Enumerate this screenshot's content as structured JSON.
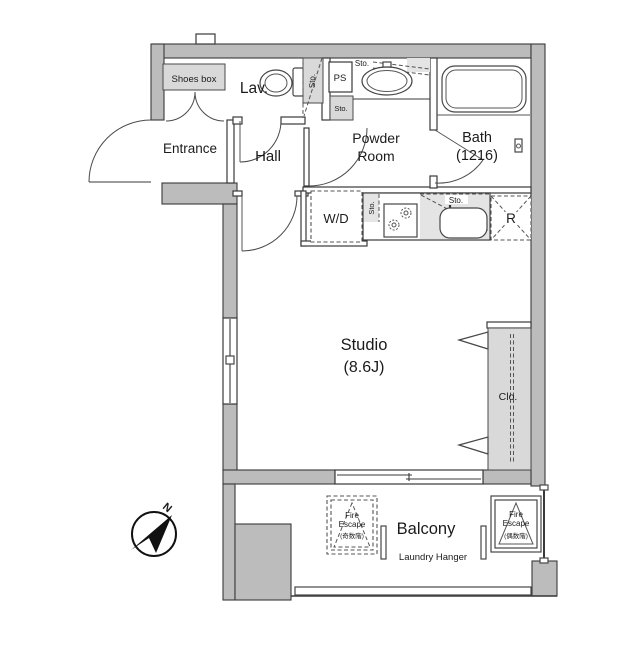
{
  "plan": {
    "entrance": "Entrance",
    "shoes_box": "Shoes box",
    "lav": "Lav.",
    "hall": "Hall",
    "ps": "PS",
    "sto": "Sto.",
    "powder_line1": "Powder",
    "powder_line2": "Room",
    "bath": "Bath",
    "bath_size": "(1216)",
    "wd": "W/D",
    "fridge": "R",
    "studio": "Studio",
    "studio_size": "(8.6J)",
    "closet": "Clo.",
    "balcony": "Balcony",
    "laundry_hanger": "Laundry Hanger",
    "fire_escape_line1": "Fire",
    "fire_escape_line2": "Escape",
    "fire_escape_left_floors": "(奇数階)",
    "fire_escape_right_floors": "(偶数階)",
    "north": "N"
  },
  "colors": {
    "wall": "#bcbcbc",
    "storage_fill": "#d9d9d9",
    "line": "#3a3a3a",
    "background": "#ffffff"
  }
}
